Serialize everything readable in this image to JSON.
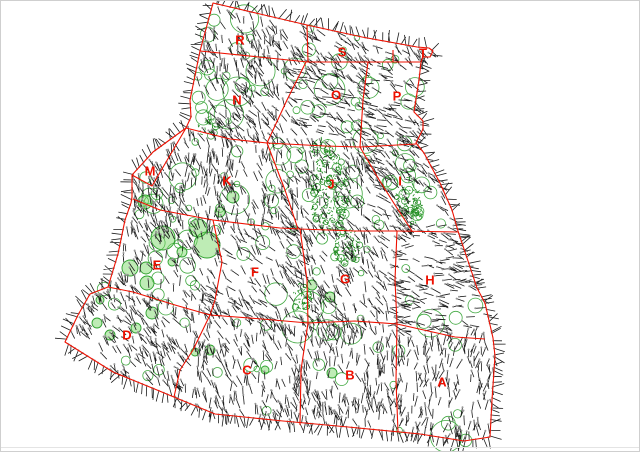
{
  "window": {
    "background": "#ffffff",
    "frame_color": "#cfcfcf",
    "bottom_rule_color": "#e4e4e4",
    "bottom_rule_y": 447
  },
  "map": {
    "width": 640,
    "height": 452,
    "border_color": "#ee1000",
    "border_width": 1.1,
    "label_color": "#ee1000",
    "label_font_size": 13,
    "tick_line_color": "#1c1c1c",
    "tick_dot_color": "#969696",
    "canopy_stroke": "#2da02d",
    "canopy_fill": "#6ed45a",
    "canopy_fill_opacity": 0.45,
    "cluster_color": "#1e8a1e",
    "seed": 987654321,
    "interior_tick_count": 2300,
    "open_circle_count": 165
  },
  "regions": [
    {
      "id": "R",
      "label": "R",
      "x": 240,
      "y": 40,
      "tick_angle": 70
    },
    {
      "id": "S",
      "label": "S",
      "x": 342,
      "y": 52,
      "tick_angle": 45
    },
    {
      "id": "T",
      "label": "T",
      "x": 423,
      "y": 53,
      "tick_angle": 45
    },
    {
      "id": "N",
      "label": "N",
      "x": 237,
      "y": 100,
      "tick_angle": 62
    },
    {
      "id": "O",
      "label": "O",
      "x": 336,
      "y": 95,
      "tick_angle": 28
    },
    {
      "id": "P",
      "label": "P",
      "x": 397,
      "y": 96,
      "tick_angle": 30
    },
    {
      "id": "M",
      "label": "M",
      "x": 150,
      "y": 171,
      "tick_angle": 75
    },
    {
      "id": "K",
      "label": "K",
      "x": 227,
      "y": 181,
      "tick_angle": 82
    },
    {
      "id": "J",
      "label": "J",
      "x": 331,
      "y": 184,
      "tick_angle": 65
    },
    {
      "id": "I",
      "label": "I",
      "x": 400,
      "y": 181,
      "tick_angle": 38
    },
    {
      "id": "E",
      "label": "E",
      "x": 157,
      "y": 265,
      "tick_angle": 70
    },
    {
      "id": "F",
      "label": "F",
      "x": 255,
      "y": 272,
      "tick_angle": 48
    },
    {
      "id": "G",
      "label": "G",
      "x": 345,
      "y": 279,
      "tick_angle": 60
    },
    {
      "id": "H",
      "label": "H",
      "x": 430,
      "y": 280,
      "tick_angle": 10
    },
    {
      "id": "D",
      "label": "D",
      "x": 127,
      "y": 335,
      "tick_angle": 58
    },
    {
      "id": "C",
      "label": "C",
      "x": 247,
      "y": 370,
      "tick_angle": 78
    },
    {
      "id": "B",
      "label": "B",
      "x": 350,
      "y": 375,
      "tick_angle": 82
    },
    {
      "id": "A",
      "label": "A",
      "x": 442,
      "y": 382,
      "tick_angle": 95
    }
  ],
  "boundaries": {
    "outer": [
      [
        213,
        3
      ],
      [
        260,
        14
      ],
      [
        307,
        25
      ],
      [
        362,
        37
      ],
      [
        417,
        47
      ],
      [
        429,
        48
      ],
      [
        433,
        51
      ],
      [
        430,
        57
      ],
      [
        423,
        57
      ],
      [
        421,
        62
      ],
      [
        419,
        80
      ],
      [
        414,
        112
      ],
      [
        423,
        121
      ],
      [
        423,
        129
      ],
      [
        416,
        143
      ],
      [
        424,
        153
      ],
      [
        440,
        183
      ],
      [
        452,
        210
      ],
      [
        458,
        231
      ],
      [
        468,
        261
      ],
      [
        477,
        288
      ],
      [
        485,
        303
      ],
      [
        493,
        338
      ],
      [
        495,
        356
      ],
      [
        492,
        400
      ],
      [
        490,
        437
      ],
      [
        464,
        441
      ],
      [
        420,
        434
      ],
      [
        348,
        427
      ],
      [
        283,
        421
      ],
      [
        215,
        414
      ],
      [
        157,
        390
      ],
      [
        113,
        372
      ],
      [
        65,
        342
      ],
      [
        78,
        315
      ],
      [
        90,
        294
      ],
      [
        108,
        287
      ],
      [
        118,
        254
      ],
      [
        125,
        220
      ],
      [
        131,
        203
      ],
      [
        132,
        197
      ],
      [
        132,
        175
      ],
      [
        153,
        152
      ],
      [
        186,
        128
      ],
      [
        191,
        117
      ],
      [
        190,
        100
      ],
      [
        200,
        51
      ]
    ],
    "internal": [
      [
        [
          200,
          51
        ],
        [
          308,
          62
        ],
        [
          368,
          62
        ],
        [
          420,
          62
        ]
      ],
      [
        [
          307,
          25
        ],
        [
          308,
          62
        ]
      ],
      [
        [
          393,
          50
        ],
        [
          393,
          62
        ]
      ],
      [
        [
          306,
          62
        ],
        [
          287,
          100
        ],
        [
          267,
          143
        ]
      ],
      [
        [
          368,
          62
        ],
        [
          363,
          100
        ],
        [
          360,
          147
        ]
      ],
      [
        [
          186,
          128
        ],
        [
          230,
          139
        ],
        [
          267,
          143
        ],
        [
          325,
          146
        ],
        [
          360,
          147
        ],
        [
          416,
          144
        ]
      ],
      [
        [
          132,
          175
        ],
        [
          152,
          186
        ],
        [
          186,
          128
        ]
      ],
      [
        [
          133,
          199
        ],
        [
          160,
          210
        ],
        [
          213,
          220
        ],
        [
          280,
          228
        ],
        [
          300,
          229
        ],
        [
          355,
          231
        ],
        [
          397,
          231
        ],
        [
          458,
          232
        ]
      ],
      [
        [
          267,
          143
        ],
        [
          285,
          190
        ],
        [
          298,
          229
        ]
      ],
      [
        [
          360,
          147
        ],
        [
          378,
          178
        ],
        [
          395,
          205
        ],
        [
          412,
          231
        ]
      ],
      [
        [
          213,
          220
        ],
        [
          222,
          262
        ],
        [
          215,
          300
        ],
        [
          210,
          315
        ]
      ],
      [
        [
          300,
          229
        ],
        [
          307,
          280
        ],
        [
          308,
          323
        ]
      ],
      [
        [
          397,
          231
        ],
        [
          395,
          280
        ],
        [
          397,
          324
        ]
      ],
      [
        [
          108,
          287
        ],
        [
          133,
          292
        ],
        [
          175,
          305
        ],
        [
          210,
          315
        ],
        [
          262,
          319
        ],
        [
          308,
          323
        ],
        [
          355,
          321
        ],
        [
          397,
          324
        ],
        [
          455,
          337
        ],
        [
          485,
          339
        ]
      ],
      [
        [
          210,
          315
        ],
        [
          193,
          350
        ],
        [
          180,
          370
        ],
        [
          174,
          397
        ]
      ],
      [
        [
          308,
          323
        ],
        [
          301,
          370
        ],
        [
          300,
          425
        ]
      ],
      [
        [
          397,
          324
        ],
        [
          396,
          380
        ],
        [
          398,
          432
        ]
      ]
    ]
  },
  "vegetation": {
    "filled_circles": [
      [
        163,
        238,
        12
      ],
      [
        207,
        245,
        13
      ],
      [
        198,
        228,
        9
      ],
      [
        130,
        268,
        8
      ],
      [
        146,
        268,
        6
      ],
      [
        147,
        283,
        7
      ],
      [
        152,
        313,
        6
      ],
      [
        136,
        328,
        5
      ],
      [
        220,
        212,
        5
      ],
      [
        233,
        197,
        6
      ],
      [
        145,
        202,
        7
      ],
      [
        182,
        252,
        5
      ],
      [
        97,
        323,
        5
      ],
      [
        110,
        335,
        5
      ],
      [
        100,
        300,
        4
      ],
      [
        312,
        285,
        5
      ],
      [
        210,
        350,
        5
      ],
      [
        265,
        370,
        4
      ],
      [
        332,
        373,
        5
      ],
      [
        195,
        352,
        4
      ],
      [
        172,
        262,
        4
      ],
      [
        330,
        297,
        5
      ]
    ],
    "clusters": [
      {
        "x": 330,
        "y": 193,
        "rx": 20,
        "ry": 42,
        "count": 230
      },
      {
        "x": 347,
        "y": 247,
        "rx": 13,
        "ry": 20,
        "count": 90
      },
      {
        "x": 302,
        "y": 297,
        "rx": 10,
        "ry": 14,
        "count": 45
      },
      {
        "x": 409,
        "y": 203,
        "rx": 13,
        "ry": 26,
        "count": 85
      },
      {
        "x": 322,
        "y": 150,
        "rx": 12,
        "ry": 12,
        "count": 40
      },
      {
        "x": 208,
        "y": 125,
        "rx": 10,
        "ry": 12,
        "count": 25
      }
    ]
  }
}
